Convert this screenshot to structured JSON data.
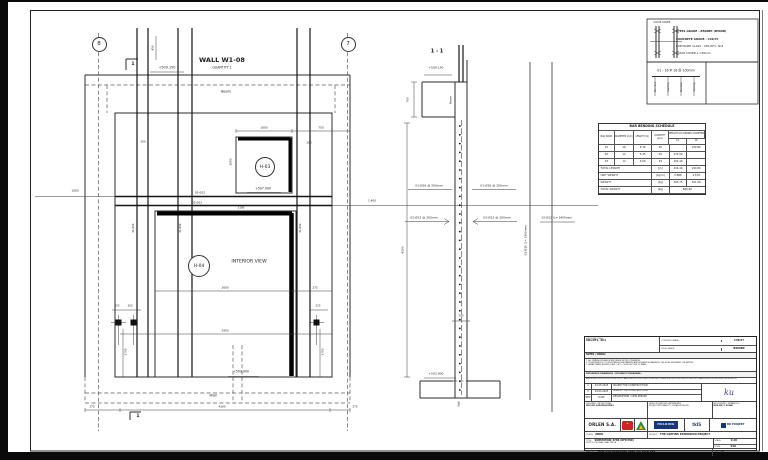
{
  "page": {
    "background": "#0a0a0a",
    "sheet_color": "#ffffff",
    "line_color": "#2b2b2b",
    "accent_red": "#d1231f",
    "accent_blue": "#16357e",
    "accent_green": "#2c8f3e"
  },
  "main_view": {
    "title": "WALL W1-08",
    "quantity": "QUANTITY 1",
    "grid_left": "8",
    "grid_right": "7",
    "opening_top": "H-03",
    "opening_main": "H-04"
  },
  "section_view": {
    "title": "1 - 1"
  },
  "notes_box": {
    "clear_cover_label": "CLEAR COVER",
    "lines": [
      "STEEL GRADE - B500BP (B500B)",
      "CONCRETE GRADE - C30/37",
      "EXPOSURE CLASS - XD1/XF1, XC4",
      "CLEAR COVER          a =50mm"
    ]
  },
  "annotations": [
    {
      "n": "view-title",
      "t": "WALL W1-08",
      "x": 222,
      "y": 60,
      "fs": 6.5,
      "b": true
    },
    {
      "n": "view-quantity",
      "t": "QUANTITY 1",
      "x": 222,
      "y": 67.5,
      "fs": 3.2
    },
    {
      "n": "level-label",
      "t": "+509.150",
      "x": 167,
      "y": 68,
      "fs": 3.4
    },
    {
      "n": "section-marker-top",
      "t": "1",
      "x": 133,
      "y": 65,
      "fs": 4.5,
      "b": true
    },
    {
      "n": "dim-label",
      "t": "450",
      "x": 153,
      "y": 48,
      "fs": 2.8,
      "v": true
    },
    {
      "n": "beam-label",
      "t": "Beam",
      "x": 226,
      "y": 92,
      "fs": 3.4
    },
    {
      "n": "dim-label",
      "t": "1600",
      "x": 264,
      "y": 128,
      "fs": 2.8
    },
    {
      "n": "dim-label",
      "t": "750",
      "x": 321,
      "y": 128,
      "fs": 2.8
    },
    {
      "n": "dim-label",
      "t": "200",
      "x": 143,
      "y": 142,
      "fs": 2.8
    },
    {
      "n": "dim-label",
      "t": "200",
      "x": 309,
      "y": 143,
      "fs": 2.8
    },
    {
      "n": "dim-label",
      "t": "1600",
      "x": 231,
      "y": 162,
      "fs": 2.8,
      "v": true
    },
    {
      "n": "level-label",
      "t": "+507.000",
      "x": 263,
      "y": 189,
      "fs": 3.2
    },
    {
      "n": "rebar-label",
      "t": "02-Ø12",
      "x": 200,
      "y": 193,
      "fs": 2.8
    },
    {
      "n": "rebar-label",
      "t": "02-Ø12",
      "x": 197,
      "y": 202.5,
      "fs": 2.8
    },
    {
      "n": "dim-label",
      "t": "1600",
      "x": 75,
      "y": 191,
      "fs": 2.8
    },
    {
      "n": "dim-label",
      "t": "1.400",
      "x": 372,
      "y": 201,
      "fs": 2.8
    },
    {
      "n": "dim-label",
      "t": "2100",
      "x": 241,
      "y": 209,
      "fs": 2.6
    },
    {
      "n": "interior-view-label",
      "t": "INTERIOR VIEW",
      "x": 249,
      "y": 263,
      "fs": 4.6
    },
    {
      "n": "dim-label",
      "t": "2600",
      "x": 225,
      "y": 288,
      "fs": 2.8
    },
    {
      "n": "dim-label",
      "t": "275",
      "x": 315,
      "y": 288,
      "fs": 2.8
    },
    {
      "n": "dim-label",
      "t": "2950",
      "x": 225,
      "y": 331,
      "fs": 2.8
    },
    {
      "n": "dim-label",
      "t": "225",
      "x": 117,
      "y": 307,
      "fs": 2.6
    },
    {
      "n": "dim-label",
      "t": "300",
      "x": 130,
      "y": 307,
      "fs": 2.6
    },
    {
      "n": "dim-label",
      "t": "225",
      "x": 318,
      "y": 307,
      "fs": 2.6
    },
    {
      "n": "dim-label",
      "t": "1750",
      "x": 126,
      "y": 352,
      "fs": 2.8,
      "v": true
    },
    {
      "n": "dim-label",
      "t": "1750",
      "x": 323,
      "y": 352,
      "fs": 2.8,
      "v": true
    },
    {
      "n": "level-label",
      "t": "+503.900",
      "x": 241,
      "y": 372,
      "fs": 3.2
    },
    {
      "n": "wall-label",
      "t": "Wall",
      "x": 213,
      "y": 396,
      "fs": 3.4,
      "i": true
    },
    {
      "n": "dim-label",
      "t": "275",
      "x": 92,
      "y": 407,
      "fs": 2.8
    },
    {
      "n": "dim-label",
      "t": "4300",
      "x": 222,
      "y": 407,
      "fs": 2.8
    },
    {
      "n": "dim-label",
      "t": "275",
      "x": 355,
      "y": 407,
      "fs": 2.8
    },
    {
      "n": "section-marker-bottom",
      "t": "1",
      "x": 138,
      "y": 417,
      "fs": 4.5,
      "b": true
    },
    {
      "n": "bar-callout",
      "t": "01-Ø16",
      "x": 134,
      "y": 228,
      "fs": 2.4,
      "v": true
    },
    {
      "n": "bar-callout",
      "t": "01-Ø16",
      "x": 181,
      "y": 228,
      "fs": 2.4,
      "v": true
    },
    {
      "n": "bar-callout",
      "t": "01-Ø16",
      "x": 301,
      "y": 228,
      "fs": 2.4,
      "v": true
    },
    {
      "n": "section-title",
      "t": "1 - 1",
      "x": 437,
      "y": 52,
      "fs": 5,
      "b": true
    },
    {
      "n": "level-label",
      "t": "+509.150",
      "x": 436,
      "y": 68,
      "fs": 3
    },
    {
      "n": "dim-label",
      "t": "700",
      "x": 408,
      "y": 100,
      "fs": 2.8,
      "v": true
    },
    {
      "n": "beam-label",
      "t": "Beam",
      "x": 451,
      "y": 100,
      "fs": 2.8,
      "v": true
    },
    {
      "n": "rebar-label",
      "t": "01-Ø16 @ 200mm",
      "x": 429,
      "y": 185.5,
      "fs": 3
    },
    {
      "n": "rebar-label",
      "t": "01-Ø16 @ 200mm",
      "x": 494,
      "y": 185.5,
      "fs": 3
    },
    {
      "n": "rebar-label",
      "t": "02-Ø12 @ 200mm",
      "x": 424,
      "y": 217.5,
      "fs": 3
    },
    {
      "n": "rebar-label",
      "t": "03-Ø12 @ 200mm",
      "x": 497,
      "y": 217.5,
      "fs": 3
    },
    {
      "n": "dim-label",
      "t": "4500",
      "x": 403,
      "y": 250,
      "fs": 2.8,
      "v": true
    },
    {
      "n": "dim-label",
      "t": "250",
      "x": 461,
      "y": 317,
      "fs": 2.6
    },
    {
      "n": "level-label",
      "t": "+503.900",
      "x": 436,
      "y": 374,
      "fs": 3
    },
    {
      "n": "slab-label",
      "t": "Slab",
      "x": 460,
      "y": 404,
      "fs": 2.6,
      "v": true
    },
    {
      "n": "bar-length-label",
      "t": "01-Ø16 (L= 5300mm)",
      "x": 526,
      "y": 240,
      "fs": 2.8,
      "v": true
    },
    {
      "n": "bar-length-label",
      "t": "02-Ø12 (L= 5450mm)",
      "x": 557,
      "y": 218,
      "fs": 2.8
    },
    {
      "n": "clear-cover-label",
      "t": "CLEAR COVER",
      "x": 662,
      "y": 23,
      "fs": 2.4
    },
    {
      "n": "callout-text",
      "t": "01 - 16 # 16 @ 100mm",
      "x": 676,
      "y": 71,
      "fs": 3.2
    },
    {
      "n": "callout-tick-label",
      "t": "Bar mark",
      "x": 656,
      "y": 87,
      "fs": 2.2,
      "v": true
    },
    {
      "n": "callout-tick-label",
      "t": "Quantity",
      "x": 669,
      "y": 87,
      "fs": 2.2,
      "v": true
    },
    {
      "n": "callout-tick-label",
      "t": "Diameter",
      "x": 682,
      "y": 87,
      "fs": 2.2,
      "v": true
    },
    {
      "n": "callout-tick-label",
      "t": "Spacing",
      "x": 695,
      "y": 87,
      "fs": 2.2,
      "v": true
    }
  ],
  "bbs": {
    "title": "BAR BENDING SCHEDULE",
    "headers": {
      "bar_mark": "BAR MARK",
      "diameter": "DIAMETER (mm)",
      "length": "LENGTH (m)",
      "quantity": "QUANTITY (pcs)",
      "weight_group": "WEIGHT ACCORDING DIAMETER",
      "sub_12": "12",
      "sub_16": "16"
    },
    "rows": [
      {
        "mark": "01",
        "dia": "16",
        "len": "5.30",
        "qty": "36",
        "w12": "",
        "w16": "190.80"
      },
      {
        "mark": "02",
        "dia": "12",
        "len": "5.45",
        "qty": "50",
        "w12": "272.00",
        "w16": ""
      },
      {
        "mark": "03",
        "dia": "12",
        "len": "5.60",
        "qty": "29",
        "w12": "162.40",
        "w16": ""
      }
    ],
    "footer": [
      {
        "label": "TOTAL LENGTH",
        "unit": "[m]",
        "v12": "434.40",
        "v16": "190.80"
      },
      {
        "label": "UNIT WEIGHT",
        "unit": "[kg/m]",
        "v12": "0.888",
        "v16": "1.578"
      },
      {
        "label": "WEIGHT",
        "unit": "[kg]",
        "v12": "385.75",
        "v16": "301.08"
      }
    ],
    "total": {
      "label": "TOTAL WEIGHT",
      "unit": "[kg]",
      "value": "686.80"
    }
  },
  "title_block": {
    "exposure_label": "EXPOSURE CLASS:",
    "exposure_value": "XD1/XF1, XC4",
    "concrete_label": "CONCRETE GRADE:",
    "concrete_value": "C30/37",
    "steel_label": "STEEL GRADE:",
    "steel_value": "B500BP",
    "notes_header": "NOTES / UWAGI:",
    "notes": [
      "1.  ALL DIMENSIONS ARE IN MM UNLESS NOTED OTHERWISE.",
      "2.  IF DIFFERENCES OCCUR BETWEEN THIS DRAWING AND REFERENCE DRAWINGS, THE MORE IMPORTANT ONE APPLIES.",
      "3.  REBAR GRADE B500BP CLASS C ACC. CROSS SECTION OF BEAM."
    ],
    "reference_header": "REFERENCE DRAWINGS / RYSUNKI POWIĄZANE:",
    "reference_list": "ABRE-SUB-Z0132/S20-3280-CIV-DWG-R01-1   ABRE-SUB-Z0132/S20-3280-CIV-DWG-R01-2   ABRE-SUB-Z0132/S20-3280-CIV-DWG-R01-3   ABRE-SUB-Z0132/S20-3280-CIV-DWG-R01-4",
    "revisions": [
      {
        "rev": "1",
        "date": "24.05.2023",
        "desc": "ISSUED FOR CONSTRUCTION"
      },
      {
        "rev": "0",
        "date": "24.04.2023",
        "desc": "ISSUED FOR CONSTRUCTION"
      },
      {
        "rev": "REV",
        "date": "DATE",
        "desc": "DESCRIPTION / OPIS ZMIANY"
      }
    ],
    "signature": "ku",
    "designed_label": "DESIGNED / PROJEKTOWAŁ:",
    "designed_value": "MGR INŻ. RADOSŁAW BERG",
    "office_line1": "BIURO PROJEKTOWO-INŻYNIERSKIE",
    "office_line2": "PROJEKT WYKONAWCZY / DETAILED DESIGN",
    "authorized_label": "AUTHORIZED / SPRAWDZIŁ:",
    "authorized_value": "MGR INŻ. P. KOWAL",
    "company": "ORLEN S.A.",
    "logo_holding": "HOLDING",
    "logo_tk": "tkIS",
    "logo_bk": "BK PROJEKT",
    "client_label": "CLIENT:",
    "client_value": "ABKK",
    "project_label": "PROJECT:",
    "project_value": "THE OLEFINS EXPANSION PROJECT",
    "title_label": "TITLE:",
    "title_line1": "SUBSTATION_8788 (OFR P80)",
    "title_line2": "FIRST FLOOR SLAB - WALL W1-08",
    "scale_label": "SCALE:",
    "scale_value": "1:20",
    "form_label": "FORM:",
    "form_value": "610",
    "dwg_label": "DWG NO:",
    "dwg_value": "ABRE-SUB-Z0132/S20-3280-CIV-DWG-R01",
    "rev_label": "REV:",
    "rev_value": "01"
  }
}
